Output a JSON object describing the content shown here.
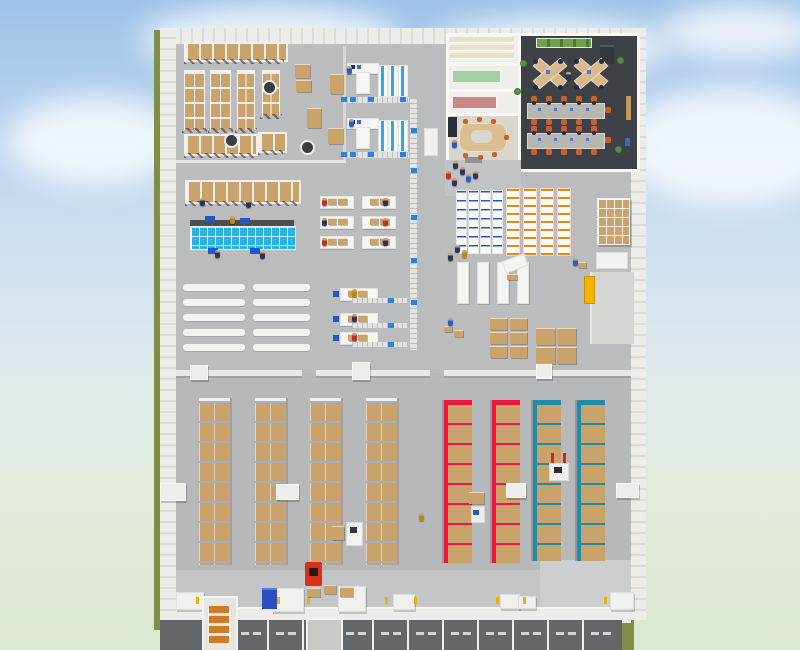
{
  "scene": {
    "view": {
      "type": "3d-top-down-warehouse-simulation"
    },
    "environment": {
      "sky_top": "#9fc2e8",
      "sky_mid": "#cfe0f2",
      "horizon": "#e2eadc",
      "grass": "#dce7d0",
      "olive_edge": "#808f46",
      "cloud": "#ffffff"
    },
    "building": {
      "wall_light": "#ecece9",
      "wall_stripe": "#dddbd5",
      "floor": "#bbbcbe",
      "floor_lower": "#b7b8b9",
      "dock_apron": "#c4c5c6",
      "dock_road": "#64676a",
      "road_line": "#eff0f0",
      "curb": "#ececea"
    },
    "palette": {
      "carton": "#c9a26c",
      "rackframe": "#9fb0cc",
      "redrack": "#ee1545",
      "tealrack": "#1d8ca6",
      "cyantote": "#29b4e6",
      "bluetote": "#2b82e0",
      "bluepallet": "#2456c8",
      "conveyorc": "#e3e3e1",
      "officefloor": "#3e4247",
      "deskwood": "#d8b98c",
      "navychair": "#1e2a52",
      "orangechair": "#cd5f28",
      "graytable": "#b8b6b1",
      "planter": "#4e7a34",
      "yellowc": "#f2b202",
      "forkliftred": "#d5311c",
      "machine": "#f1f1ef"
    },
    "inventory": {
      "pallet_rack_columns_tan": 4,
      "pallet_rack_columns_red": 2,
      "pallet_rack_columns_teal": 2,
      "top_left_vertical_racks": 4,
      "workstation_cells": 2,
      "packing_tables": 6,
      "packing_stations": 3,
      "flow_lanes": 10,
      "bin_shelf_rows_blue": 4,
      "bin_shelf_rows_orange": 4,
      "dock_lanes": 11,
      "trucks_at_dock": 2,
      "forklifts": 4,
      "workers": 30,
      "office": {
        "cross_desk_clusters": 2,
        "long_tables": 2,
        "meeting_rooms": 1,
        "small_rooms": 2,
        "storage_rooms": 1
      }
    }
  }
}
